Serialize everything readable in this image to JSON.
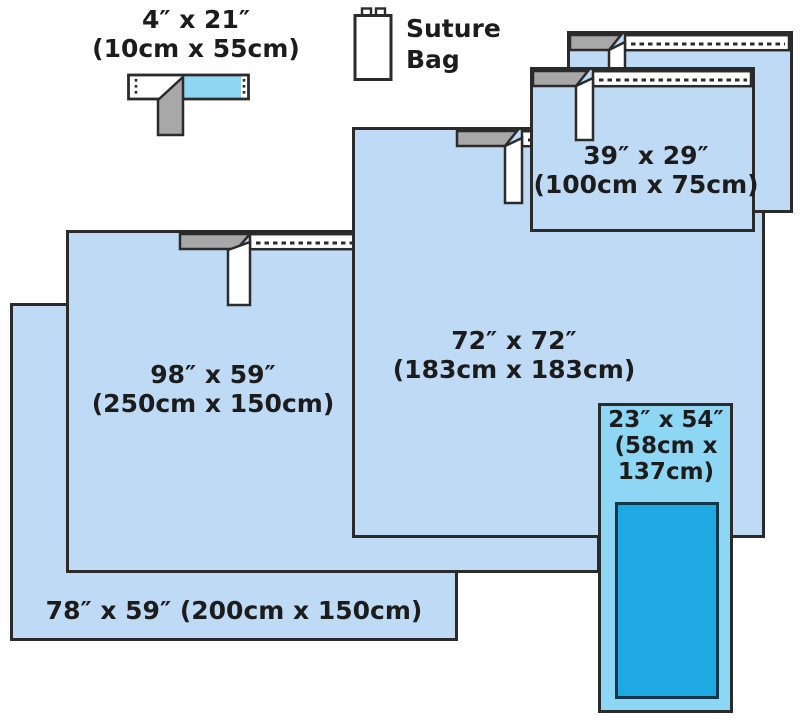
{
  "diagram": {
    "tape_4x21": {
      "size_in": "4″ x 21″",
      "size_cm": "(10cm x 55cm)"
    },
    "suture_bag": {
      "line1": "Suture",
      "line2": "Bag"
    },
    "drape_39x29": {
      "size_in": "39″ x 29″",
      "size_cm": "(100cm x 75cm)"
    },
    "drape_72x72": {
      "size_in": "72″ x 72″",
      "size_cm": "(183cm x 183cm)"
    },
    "drape_98x59": {
      "size_in": "98″ x 59″",
      "size_cm": "(250cm x 150cm)"
    },
    "drape_78x59": {
      "label": "78″ x 59″ (200cm x 150cm)"
    },
    "drape_23x54": {
      "line1": "23″ x 54″",
      "line2": "(58cm x",
      "line3": "137cm)"
    }
  },
  "colors": {
    "background": "#ffffff",
    "drape_blue": "#bfdaf5",
    "drape_cyan_light": "#8dd6f4",
    "drape_cyan": "#1ea9e2",
    "tape_gray": "#a8a8a8",
    "outline": "#2b2b2b",
    "text": "#1c1c1c"
  }
}
